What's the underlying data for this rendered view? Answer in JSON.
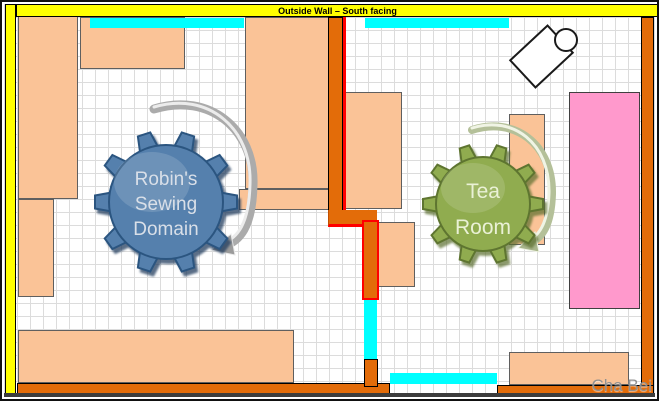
{
  "banner": {
    "label": "Outside Wall – South facing"
  },
  "watermark": "Cha Bei",
  "colors": {
    "wall_yellow": "#FFFF00",
    "wall_orange": "#E36C09",
    "accent_red": "#FF0000",
    "window_cyan": "#00FFFF",
    "furniture_peach": "#FAC397",
    "table_pink": "#FF99CC",
    "grid_line": "#DCDCDC",
    "gear_blue": "#5580AD",
    "gear_green": "#90AC4F",
    "arrow_silver": "#ABABAB",
    "arrow_green_silver": "#B4C099"
  },
  "gears": {
    "sewing": {
      "lines": [
        "Robin's",
        "Sewing",
        "Domain"
      ]
    },
    "tea": {
      "lines": [
        "Tea",
        "Room"
      ]
    }
  },
  "shapes": [
    {
      "name": "furniture-left-tall",
      "cls": "furn",
      "fill": "furniture_peach",
      "x": 16,
      "y": 13,
      "w": 60,
      "h": 184
    },
    {
      "name": "furniture-left-narrow",
      "cls": "furn",
      "fill": "furniture_peach",
      "x": 16,
      "y": 197,
      "w": 36,
      "h": 98
    },
    {
      "name": "furniture-top-left",
      "cls": "furn",
      "fill": "furniture_peach",
      "x": 78,
      "y": 15,
      "w": 105,
      "h": 52
    },
    {
      "name": "furniture-center-tall",
      "cls": "furn",
      "fill": "furniture_peach",
      "x": 243,
      "y": 15,
      "w": 84,
      "h": 172
    },
    {
      "name": "furniture-center-band",
      "cls": "furn",
      "fill": "furniture_peach",
      "x": 237,
      "y": 187,
      "w": 90,
      "h": 21
    },
    {
      "name": "furniture-bottom-left",
      "cls": "furn",
      "fill": "furniture_peach",
      "x": 16,
      "y": 328,
      "w": 276,
      "h": 53
    },
    {
      "name": "furniture-mid-right",
      "cls": "furn",
      "fill": "furniture_peach",
      "x": 342,
      "y": 90,
      "w": 58,
      "h": 117
    },
    {
      "name": "furniture-below-jog",
      "cls": "furn",
      "fill": "furniture_peach",
      "x": 375,
      "y": 220,
      "w": 38,
      "h": 65
    },
    {
      "name": "furniture-tea-side",
      "cls": "furn",
      "fill": "furniture_peach",
      "x": 507,
      "y": 112,
      "w": 36,
      "h": 131
    },
    {
      "name": "furniture-bottom-right",
      "cls": "furn",
      "fill": "furniture_peach",
      "x": 507,
      "y": 350,
      "w": 120,
      "h": 33
    },
    {
      "name": "pink-table",
      "cls": "pinkT",
      "fill": "table_pink",
      "x": 567,
      "y": 90,
      "w": 71,
      "h": 217
    },
    {
      "name": "wall-left",
      "cls": "wallY",
      "fill": "wall_yellow",
      "x": 3,
      "y": 2,
      "w": 11,
      "h": 393
    },
    {
      "name": "wall-right",
      "cls": "wallO",
      "fill": "wall_orange",
      "x": 639,
      "y": 15,
      "w": 13,
      "h": 380
    },
    {
      "name": "wall-bottom-left",
      "cls": "wallO",
      "fill": "wall_orange",
      "x": 15,
      "y": 381,
      "w": 373,
      "h": 13
    },
    {
      "name": "wall-bottom-right",
      "cls": "wallO",
      "fill": "wall_orange",
      "x": 495,
      "y": 383,
      "w": 157,
      "h": 12
    },
    {
      "name": "wall-mid-upper",
      "cls": "wallO",
      "fill": "wall_orange",
      "x": 326,
      "y": 15,
      "w": 15,
      "h": 196
    },
    {
      "name": "wall-mid-red-stripe",
      "cls": "redline",
      "fill": "accent_red",
      "x": 341,
      "y": 15,
      "w": 3,
      "h": 199
    },
    {
      "name": "wall-mid-jog",
      "cls": "jog",
      "fill": "wall_orange",
      "x": 326,
      "y": 208,
      "w": 49,
      "h": 17
    },
    {
      "name": "wall-mid-lower",
      "cls": "lowerSeg",
      "fill": "wall_orange",
      "x": 360,
      "y": 218,
      "w": 17,
      "h": 80
    },
    {
      "name": "window-mid-vertical",
      "cls": "window",
      "fill": "window_cyan",
      "x": 362,
      "y": 298,
      "w": 13,
      "h": 61
    },
    {
      "name": "wall-mid-base",
      "cls": "wallO",
      "fill": "wall_orange",
      "x": 362,
      "y": 357,
      "w": 14,
      "h": 28
    },
    {
      "name": "window-top-left",
      "cls": "window",
      "fill": "window_cyan",
      "x": 88,
      "y": 16,
      "w": 154,
      "h": 10
    },
    {
      "name": "window-top-right",
      "cls": "window",
      "fill": "window_cyan",
      "x": 363,
      "y": 16,
      "w": 144,
      "h": 10
    },
    {
      "name": "window-bottom",
      "cls": "window",
      "fill": "window_cyan",
      "x": 388,
      "y": 371,
      "w": 107,
      "h": 11
    }
  ]
}
